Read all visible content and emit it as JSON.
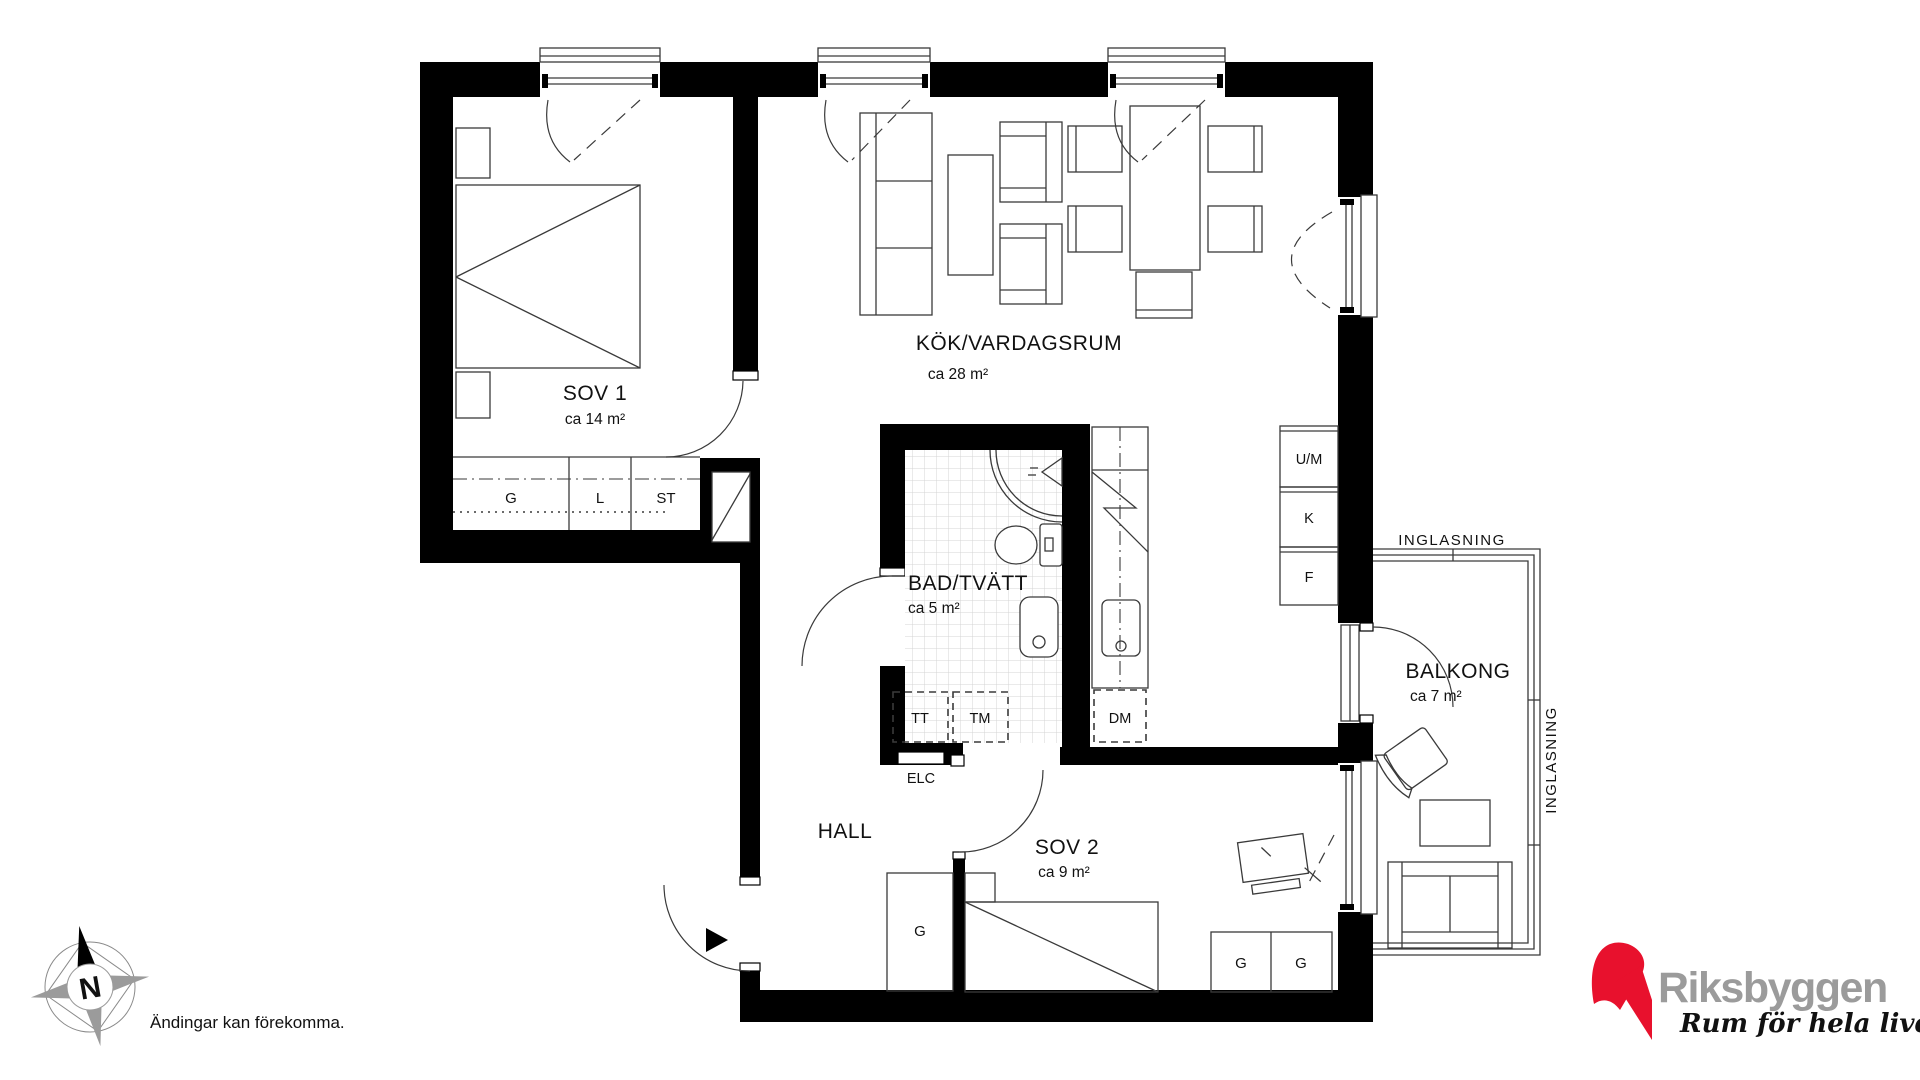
{
  "rooms": {
    "sov1": {
      "name": "SOV 1",
      "area": "ca 14 m²"
    },
    "kok": {
      "name": "KÖK/VARDAGSRUM",
      "area": "ca 28 m²"
    },
    "bad": {
      "name": "BAD/TVÄTT",
      "area": "ca 5 m²"
    },
    "hall": {
      "name": "HALL"
    },
    "sov2": {
      "name": "SOV 2",
      "area": "ca 9 m²"
    },
    "balkong": {
      "name": "BALKONG",
      "area": "ca 7 m²"
    }
  },
  "storage": {
    "sov1_g": "G",
    "sov1_l": "L",
    "sov1_st": "ST",
    "hall_g": "G",
    "sov2_g1": "G",
    "sov2_g2": "G"
  },
  "appliances": {
    "um": "U/M",
    "k": "K",
    "f": "F",
    "tt": "TT",
    "tm": "TM",
    "dm": "DM",
    "elc": "ELC"
  },
  "glazing": {
    "top": "INGLASNING",
    "right": "INGLASNING"
  },
  "compass": {
    "north": "N"
  },
  "disclaimer": "Ändingar kan förekomma.",
  "logo": {
    "name": "Riksbyggen",
    "tagline": "Rum för hela livet"
  },
  "colors": {
    "wall": "#000000",
    "line": "#3a3a3a",
    "tile": "#d4d4d4",
    "brand_red": "#e8112d",
    "brand_gray": "#9b9b9b"
  }
}
